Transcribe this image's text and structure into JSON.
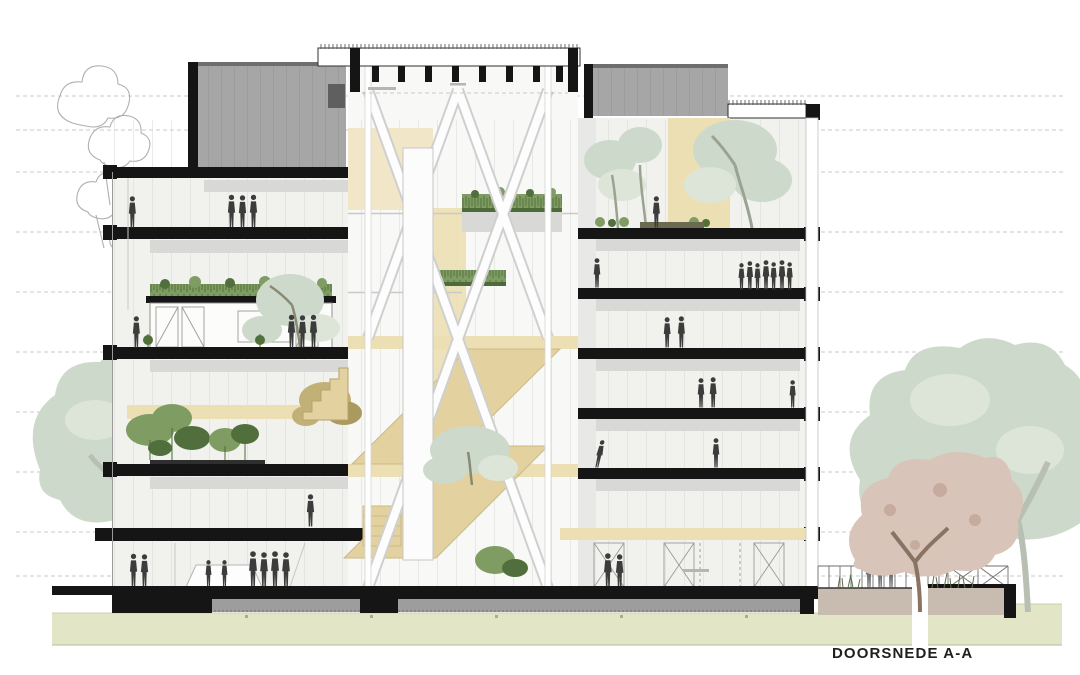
{
  "drawing": {
    "title": "DOORSNEDE A-A",
    "kind": "architectural building cross-section",
    "building": {
      "left_wing_levels": 5,
      "right_wing_levels": 6,
      "has_central_atrium": true,
      "atrium_features": [
        "x-bracing",
        "elevator-shaft",
        "stairs",
        "roof-gardens"
      ]
    }
  },
  "colors": {
    "ink": "#151515",
    "roof_gray": "#a6a6a6",
    "foundation_gray": "#9d9d9d",
    "interior_gray": "#f1f1ee",
    "ceiling_gray": "#d8d8d6",
    "beige": "#ecdfb4",
    "beige_dark": "#e3d2a0",
    "plant_green": "#7f9c63",
    "plant_dark": "#516f3c",
    "sage_tree": "#cdd9ca",
    "blossom_tree": "#d8c4b9",
    "trunk_brown": "#8a7362",
    "ground_green": "#e2e5c6",
    "terrace_wall": "#c8bbb0",
    "people": "#3c3c3c",
    "level_line": "#c9c9c9",
    "title_color": "#1f1f1f"
  }
}
